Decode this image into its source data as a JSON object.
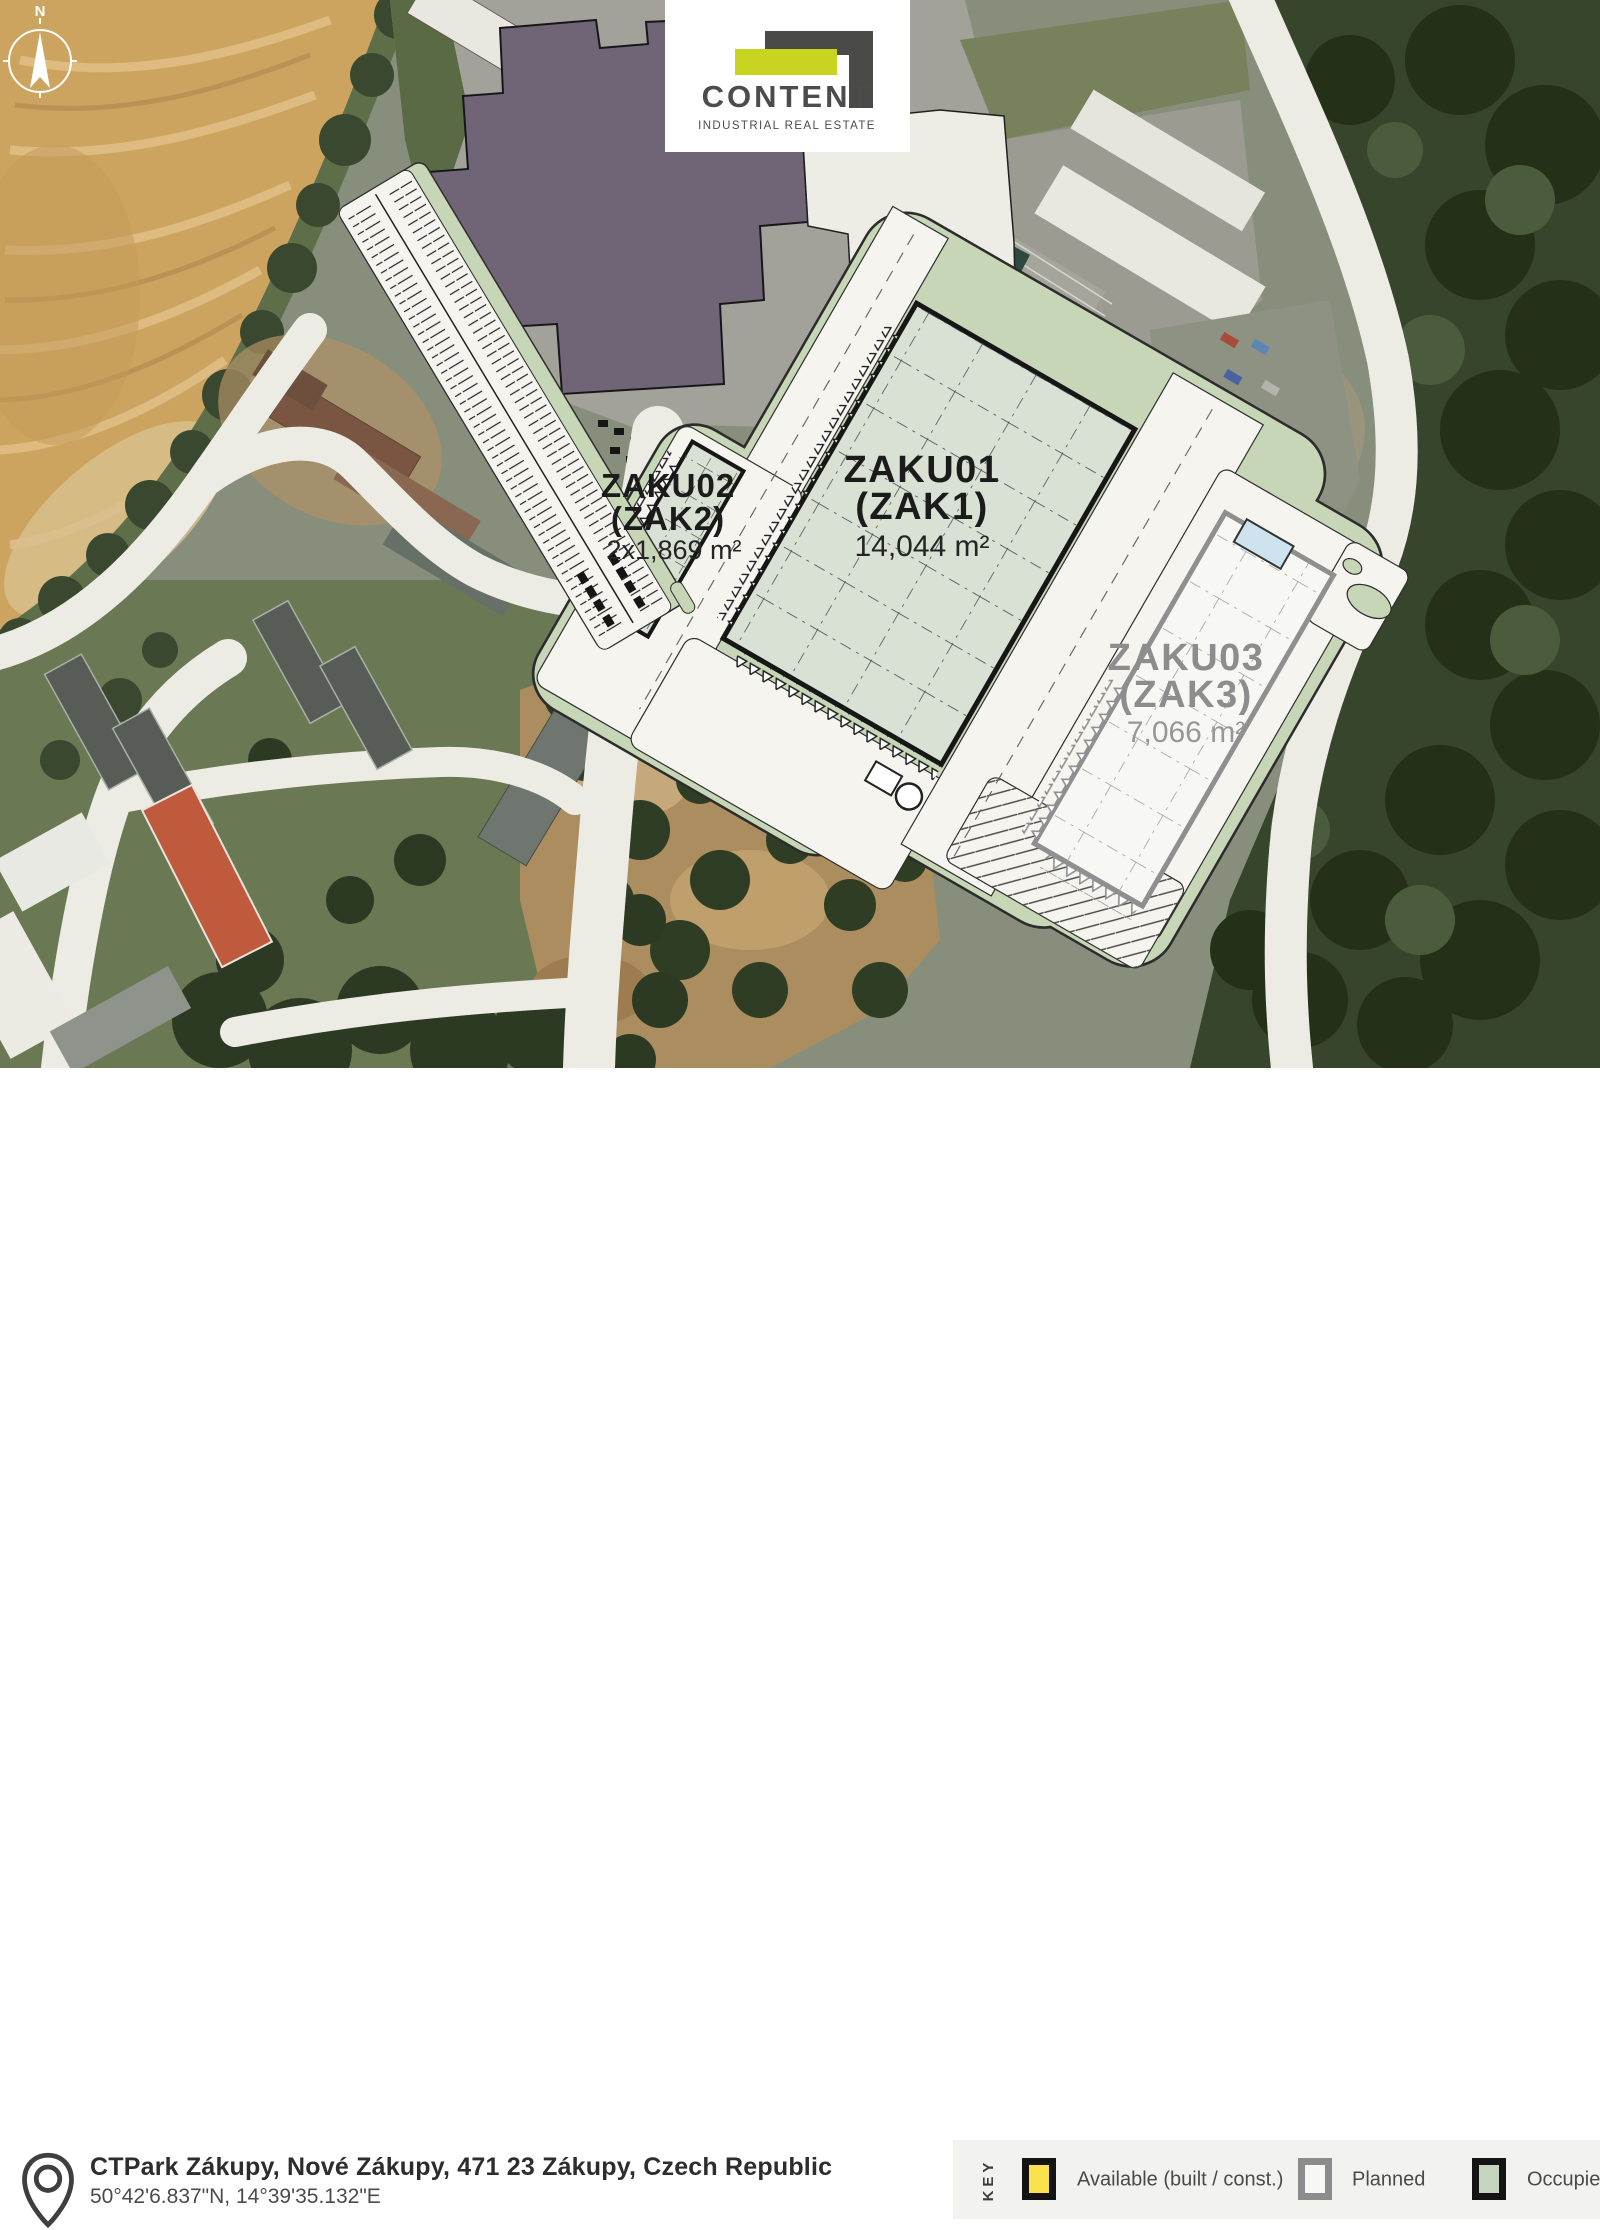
{
  "logo": {
    "name": "CONTENT",
    "tagline": "INDUSTRIAL REAL ESTATE"
  },
  "compass": {
    "north_label": "N"
  },
  "site": {
    "park_name": "CTPark Zákupy",
    "buildings": [
      {
        "code": "ZAKU01",
        "alt_code": "(ZAK1)",
        "area": "14,044 m²",
        "status": "Occupied"
      },
      {
        "code": "ZAKU02",
        "alt_code": "(ZAK2)",
        "area": "2x1,869 m²",
        "status": "Occupied"
      },
      {
        "code": "ZAKU03",
        "alt_code": "(ZAK3)",
        "area": "7,066 m²",
        "status": "Planned"
      }
    ]
  },
  "footer": {
    "address": "CTPark Zákupy, Nové Zákupy, 471 23 Zákupy, Czech Republic",
    "coordinates": "50°42'6.837\"N, 14°39'35.132\"E"
  },
  "legend": {
    "title": "KEY",
    "items": [
      {
        "label": "Available (built / const.)",
        "fill": "#f9e24c",
        "border": "#141414"
      },
      {
        "label": "Planned",
        "fill": "#f7f7f3",
        "border": "#8c8c8c"
      },
      {
        "label": "Occupied",
        "fill": "#c6d3bd",
        "border": "#141414"
      }
    ]
  },
  "colors": {
    "plan_white": "#f5f4ef",
    "landscape_green": "#c6d6b6",
    "occupied_fill": "#d8e1d3",
    "planned_fill": "#f7f7f4",
    "outline_dark": "#1f1f1f",
    "planned_outline": "#8f8f8f",
    "logo_accent": "#c8d420"
  }
}
